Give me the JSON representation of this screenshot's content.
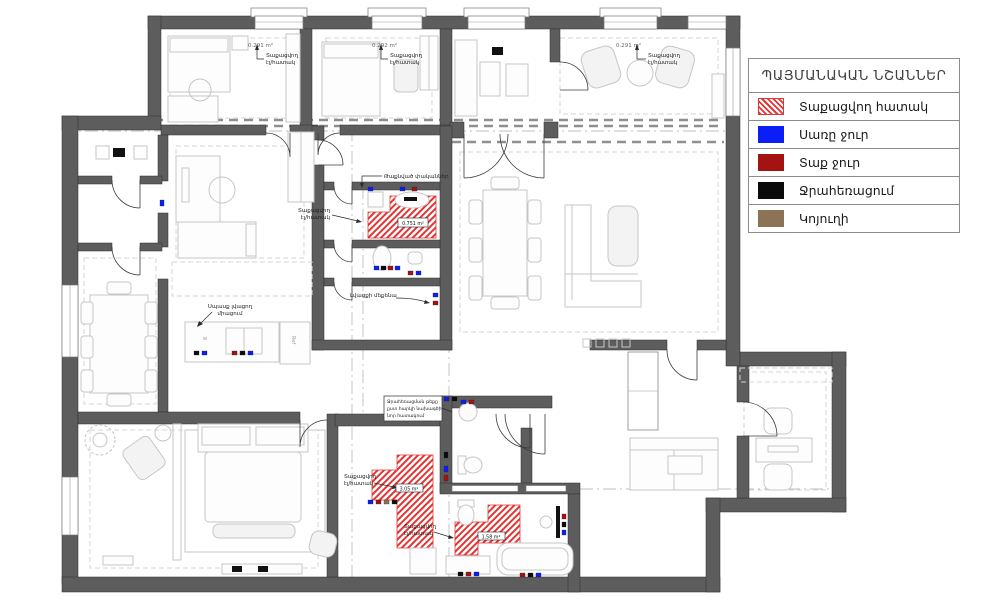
{
  "palette": {
    "wall": "#5d5d5d",
    "hatch": "#e23535",
    "cold": "#0a1ef5",
    "hot": "#a31312",
    "drain": "#0b0b0b",
    "sewer": "#8d7356"
  },
  "legend": {
    "title": "ՊԱՅՄԱՆԱԿԱՆ ՆՇԱՆՆԵՐ",
    "items": [
      {
        "label": "Տաքացվող հատակ",
        "swatch": "heated-floor-hatch"
      },
      {
        "label": "Սառը ջուր",
        "swatch": "cold-water-blue"
      },
      {
        "label": "Տաք ջուր",
        "swatch": "hot-water-darkred"
      },
      {
        "label": "Ջրահեռացում",
        "swatch": "drainage-black"
      },
      {
        "label": "Կոյուղի",
        "swatch": "sewer-brown"
      }
    ]
  },
  "annotations": {
    "heated_floor_line1": "Տաքացվող",
    "heated_floor_line2": "էլ/հատակ",
    "area_bedroom1": "0.291 m²",
    "area_bedroom2": "0.292 m²",
    "area_lounge": "0.291 m²",
    "area_bathroom": "0.751 m²",
    "area_laundry": "3.05 m²",
    "area_bath2": "1.58 m²",
    "hidden_valves": "Թաքնված փականներ",
    "washing_machine": "Լվացքի մեքենա",
    "dishwasher_line1": "Սպասք լվացող",
    "dishwasher_line2": "միացում",
    "note_line1": "Ջրահեռացման թեքը",
    "note_line2": "ըստ հարկի նախագծի",
    "note_line3": "նոր հատակում",
    "fridge": "Ref",
    "sink": "w"
  }
}
